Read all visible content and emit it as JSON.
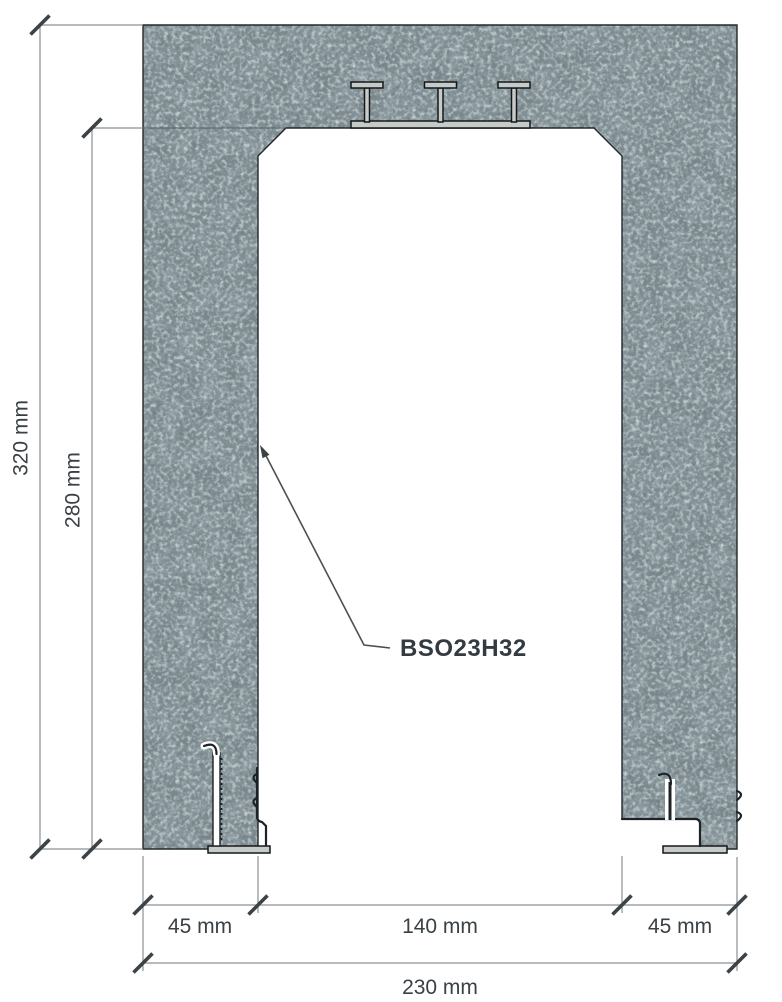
{
  "drawing": {
    "part_label": "BSO23H32",
    "unit": "mm",
    "dimensions": {
      "total_height": {
        "label": "320 mm",
        "value_mm": 320
      },
      "opening_height": {
        "label": "280 mm",
        "value_mm": 280
      },
      "left_wall": {
        "label": "45 mm",
        "value_mm": 45
      },
      "opening_width": {
        "label": "140 mm",
        "value_mm": 140
      },
      "right_wall": {
        "label": "45 mm",
        "value_mm": 45
      },
      "total_width": {
        "label": "230 mm",
        "value_mm": 230
      }
    },
    "colors": {
      "background": "#ffffff",
      "concrete_base": "#7b898e",
      "concrete_dark_speckle": "#46545a",
      "concrete_light_speckle": "#b2bcbd",
      "outline": "#22282c",
      "steel_fill": "#c7cbc8",
      "dimension_line": "#8c9195",
      "tick": "#3b4347",
      "text": "#3a4145"
    }
  }
}
